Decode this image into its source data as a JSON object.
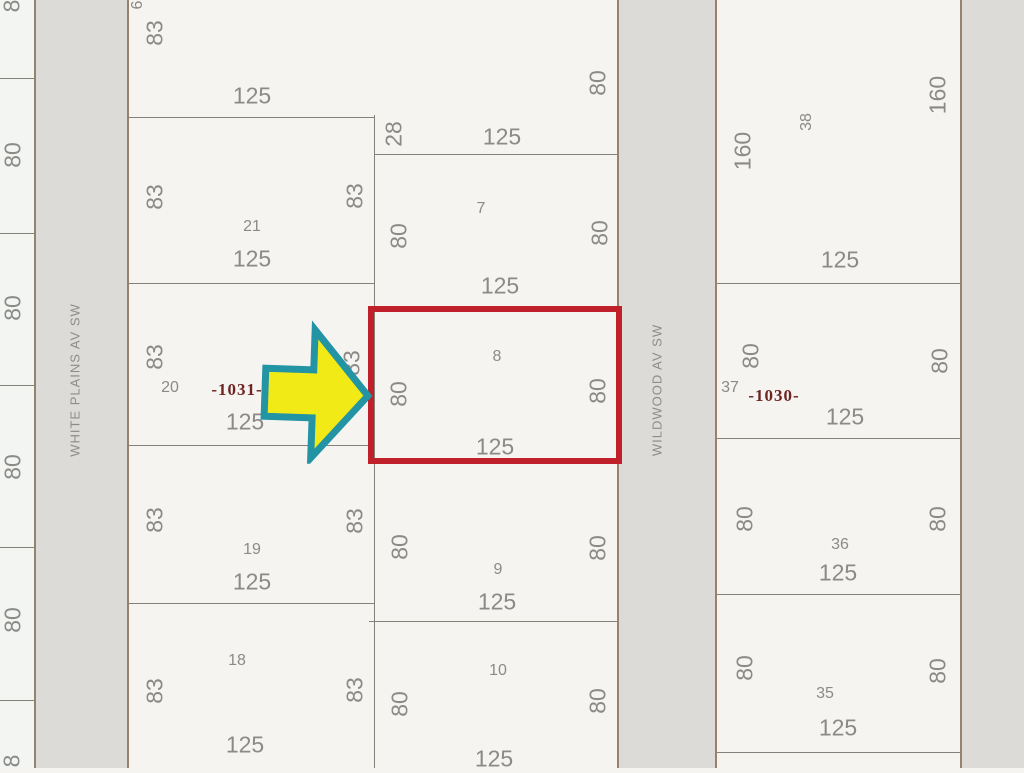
{
  "streets": {
    "west": "WHITE PLAINS AV SW",
    "east": "WILDWOOD AV SW"
  },
  "highlight": {
    "lot": "8",
    "rect_color": "#c0202a",
    "arrow_fill": "#f2ea16",
    "arrow_stroke": "#2294a4"
  },
  "labels": [
    {
      "text": "8",
      "x": 12,
      "y": 6,
      "v": true,
      "cls": "dim"
    },
    {
      "text": "80",
      "x": 13,
      "y": 155,
      "v": true,
      "cls": "dim"
    },
    {
      "text": "80",
      "x": 13,
      "y": 308,
      "v": true,
      "cls": "dim"
    },
    {
      "text": "80",
      "x": 13,
      "y": 467,
      "v": true,
      "cls": "dim"
    },
    {
      "text": "80",
      "x": 13,
      "y": 620,
      "v": true,
      "cls": "dim"
    },
    {
      "text": "8",
      "x": 12,
      "y": 761,
      "v": true,
      "cls": "dim"
    },
    {
      "text": "6",
      "x": 138,
      "y": 5,
      "v": true,
      "cls": "num"
    },
    {
      "text": "83",
      "x": 155,
      "y": 33,
      "v": true,
      "cls": "dim"
    },
    {
      "text": "125",
      "x": 252,
      "y": 96,
      "v": false,
      "cls": "dim"
    },
    {
      "text": "83",
      "x": 155,
      "y": 197,
      "v": true,
      "cls": "dim"
    },
    {
      "text": "83",
      "x": 355,
      "y": 196,
      "v": true,
      "cls": "dim"
    },
    {
      "text": "21",
      "x": 252,
      "y": 227,
      "v": false,
      "cls": "num"
    },
    {
      "text": "125",
      "x": 252,
      "y": 259,
      "v": false,
      "cls": "dim"
    },
    {
      "text": "83",
      "x": 155,
      "y": 357,
      "v": true,
      "cls": "dim"
    },
    {
      "text": "20",
      "x": 170,
      "y": 388,
      "v": false,
      "cls": "num"
    },
    {
      "text": "-1031-",
      "x": 237,
      "y": 390,
      "v": false,
      "cls": "block"
    },
    {
      "text": "125",
      "x": 245,
      "y": 422,
      "v": false,
      "cls": "dim"
    },
    {
      "text": "83",
      "x": 352,
      "y": 363,
      "v": true,
      "cls": "dim"
    },
    {
      "text": "83",
      "x": 155,
      "y": 520,
      "v": true,
      "cls": "dim"
    },
    {
      "text": "83",
      "x": 355,
      "y": 521,
      "v": true,
      "cls": "dim"
    },
    {
      "text": "19",
      "x": 252,
      "y": 550,
      "v": false,
      "cls": "num"
    },
    {
      "text": "125",
      "x": 252,
      "y": 582,
      "v": false,
      "cls": "dim"
    },
    {
      "text": "18",
      "x": 237,
      "y": 661,
      "v": false,
      "cls": "num"
    },
    {
      "text": "83",
      "x": 155,
      "y": 691,
      "v": true,
      "cls": "dim"
    },
    {
      "text": "83",
      "x": 355,
      "y": 690,
      "v": true,
      "cls": "dim"
    },
    {
      "text": "125",
      "x": 245,
      "y": 745,
      "v": false,
      "cls": "dim"
    },
    {
      "text": "28",
      "x": 394,
      "y": 134,
      "v": true,
      "cls": "dim"
    },
    {
      "text": "125",
      "x": 502,
      "y": 137,
      "v": false,
      "cls": "dim"
    },
    {
      "text": "80",
      "x": 598,
      "y": 83,
      "v": true,
      "cls": "dim"
    },
    {
      "text": "7",
      "x": 481,
      "y": 209,
      "v": false,
      "cls": "num"
    },
    {
      "text": "80",
      "x": 399,
      "y": 236,
      "v": true,
      "cls": "dim"
    },
    {
      "text": "80",
      "x": 600,
      "y": 233,
      "v": true,
      "cls": "dim"
    },
    {
      "text": "125",
      "x": 500,
      "y": 286,
      "v": false,
      "cls": "dim"
    },
    {
      "text": "8",
      "x": 497,
      "y": 357,
      "v": false,
      "cls": "num"
    },
    {
      "text": "80",
      "x": 399,
      "y": 394,
      "v": true,
      "cls": "dim"
    },
    {
      "text": "80",
      "x": 598,
      "y": 391,
      "v": true,
      "cls": "dim"
    },
    {
      "text": "125",
      "x": 495,
      "y": 447,
      "v": false,
      "cls": "dim"
    },
    {
      "text": "80",
      "x": 400,
      "y": 547,
      "v": true,
      "cls": "dim"
    },
    {
      "text": "80",
      "x": 598,
      "y": 548,
      "v": true,
      "cls": "dim"
    },
    {
      "text": "9",
      "x": 498,
      "y": 570,
      "v": false,
      "cls": "num"
    },
    {
      "text": "125",
      "x": 497,
      "y": 602,
      "v": false,
      "cls": "dim"
    },
    {
      "text": "10",
      "x": 498,
      "y": 671,
      "v": false,
      "cls": "num"
    },
    {
      "text": "80",
      "x": 400,
      "y": 704,
      "v": true,
      "cls": "dim"
    },
    {
      "text": "80",
      "x": 598,
      "y": 701,
      "v": true,
      "cls": "dim"
    },
    {
      "text": "125",
      "x": 494,
      "y": 759,
      "v": false,
      "cls": "dim"
    },
    {
      "text": "160",
      "x": 743,
      "y": 151,
      "v": true,
      "cls": "dim"
    },
    {
      "text": "38",
      "x": 807,
      "y": 122,
      "v": true,
      "cls": "num"
    },
    {
      "text": "160",
      "x": 938,
      "y": 95,
      "v": true,
      "cls": "dim"
    },
    {
      "text": "125",
      "x": 840,
      "y": 260,
      "v": false,
      "cls": "dim"
    },
    {
      "text": "80",
      "x": 751,
      "y": 356,
      "v": true,
      "cls": "dim"
    },
    {
      "text": "37",
      "x": 730,
      "y": 388,
      "v": false,
      "cls": "num"
    },
    {
      "text": "-1030-",
      "x": 774,
      "y": 396,
      "v": false,
      "cls": "block"
    },
    {
      "text": "125",
      "x": 845,
      "y": 417,
      "v": false,
      "cls": "dim"
    },
    {
      "text": "80",
      "x": 940,
      "y": 361,
      "v": true,
      "cls": "dim"
    },
    {
      "text": "80",
      "x": 745,
      "y": 519,
      "v": true,
      "cls": "dim"
    },
    {
      "text": "36",
      "x": 840,
      "y": 545,
      "v": false,
      "cls": "num"
    },
    {
      "text": "125",
      "x": 838,
      "y": 573,
      "v": false,
      "cls": "dim"
    },
    {
      "text": "80",
      "x": 938,
      "y": 519,
      "v": true,
      "cls": "dim"
    },
    {
      "text": "80",
      "x": 745,
      "y": 668,
      "v": true,
      "cls": "dim"
    },
    {
      "text": "35",
      "x": 825,
      "y": 694,
      "v": false,
      "cls": "num"
    },
    {
      "text": "125",
      "x": 838,
      "y": 728,
      "v": false,
      "cls": "dim"
    },
    {
      "text": "80",
      "x": 938,
      "y": 671,
      "v": true,
      "cls": "dim"
    }
  ],
  "lines": [
    {
      "x": 34,
      "y": 0,
      "w": 2,
      "h": 768,
      "cls": "street-line"
    },
    {
      "x": 127,
      "y": 0,
      "w": 2,
      "h": 768,
      "cls": "street-line"
    },
    {
      "x": 617,
      "y": 0,
      "w": 2,
      "h": 768,
      "cls": "street-line"
    },
    {
      "x": 715,
      "y": 0,
      "w": 2,
      "h": 768,
      "cls": "street-line"
    },
    {
      "x": 960,
      "y": 0,
      "w": 2,
      "h": 768,
      "cls": "street-line"
    },
    {
      "x": 374,
      "y": 115,
      "w": 1,
      "h": 653,
      "cls": "lot-line"
    },
    {
      "x": 0,
      "y": 78,
      "w": 34,
      "h": 1,
      "cls": "lot-line"
    },
    {
      "x": 0,
      "y": 233,
      "w": 34,
      "h": 1,
      "cls": "lot-line"
    },
    {
      "x": 0,
      "y": 385,
      "w": 34,
      "h": 1,
      "cls": "lot-line"
    },
    {
      "x": 0,
      "y": 547,
      "w": 34,
      "h": 1,
      "cls": "lot-line"
    },
    {
      "x": 0,
      "y": 700,
      "w": 34,
      "h": 1,
      "cls": "lot-line"
    },
    {
      "x": 129,
      "y": 117,
      "w": 246,
      "h": 1,
      "cls": "lot-line"
    },
    {
      "x": 129,
      "y": 283,
      "w": 246,
      "h": 1,
      "cls": "lot-line"
    },
    {
      "x": 129,
      "y": 445,
      "w": 246,
      "h": 1,
      "cls": "lot-line"
    },
    {
      "x": 129,
      "y": 603,
      "w": 246,
      "h": 1,
      "cls": "lot-line"
    },
    {
      "x": 374,
      "y": 154,
      "w": 243,
      "h": 1,
      "cls": "lot-line"
    },
    {
      "x": 369,
      "y": 621,
      "w": 248,
      "h": 1,
      "cls": "lot-line"
    },
    {
      "x": 717,
      "y": 283,
      "w": 243,
      "h": 1,
      "cls": "lot-line"
    },
    {
      "x": 717,
      "y": 438,
      "w": 243,
      "h": 1,
      "cls": "lot-line"
    },
    {
      "x": 717,
      "y": 594,
      "w": 243,
      "h": 1,
      "cls": "lot-line"
    },
    {
      "x": 717,
      "y": 752,
      "w": 243,
      "h": 1,
      "cls": "lot-line"
    }
  ]
}
